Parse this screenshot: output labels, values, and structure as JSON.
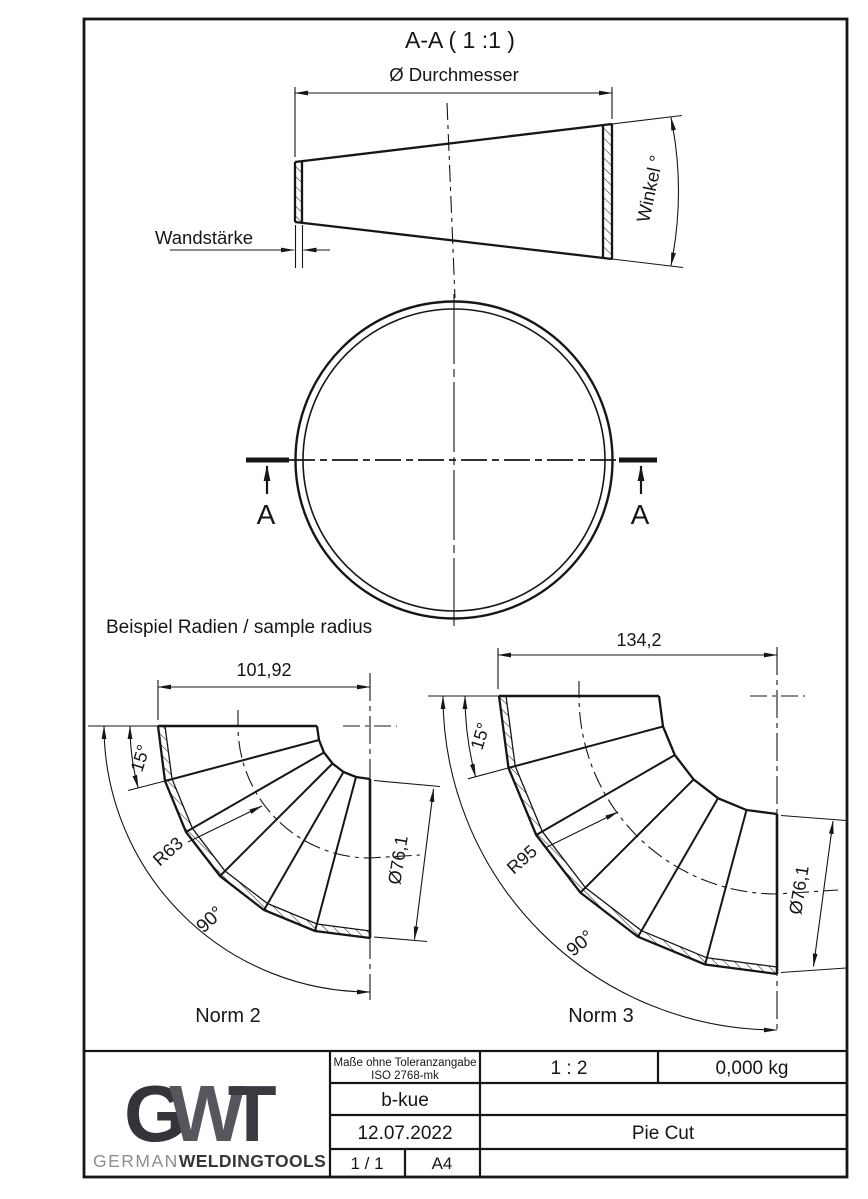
{
  "header": {
    "section_title": "A-A ( 1 :1 )"
  },
  "cone_view": {
    "diameter_label": "Ø Durchmesser",
    "wall_label": "Wandstärke",
    "angle_label": "Winkel °"
  },
  "circle_view": {
    "section_letter": "A"
  },
  "samples": {
    "heading": "Beispiel Radien / sample radius",
    "norm2": {
      "name": "Norm 2",
      "width": "101,92",
      "segment_angle": "15°",
      "radius": "R63",
      "sweep_angle": "90°",
      "pipe_diameter": "Ø76,1"
    },
    "norm3": {
      "name": "Norm 3",
      "width": "134,2",
      "segment_angle": "15°",
      "radius": "R95",
      "sweep_angle": "90°",
      "pipe_diameter": "Ø76,1"
    }
  },
  "title_block": {
    "tolerance_note_line1": "Maße ohne Toleranzangabe",
    "tolerance_note_line2": "ISO 2768-mk",
    "creator": "b-kue",
    "date": "12.07.2022",
    "scale": "1 : 2",
    "weight": "0,000 kg",
    "part_name": "Pie Cut",
    "sheet": "1 / 1",
    "paper_format": "A4",
    "logo": {
      "g": "G",
      "w": "W",
      "t": "T",
      "brand_light": "GERMAN",
      "brand_bold": "WELDINGTOOLS"
    }
  },
  "colors": {
    "ink": "#161616",
    "logo_dark": "#34353b",
    "logo_mid": "#56575d",
    "brand_light": "#8e8e92"
  }
}
